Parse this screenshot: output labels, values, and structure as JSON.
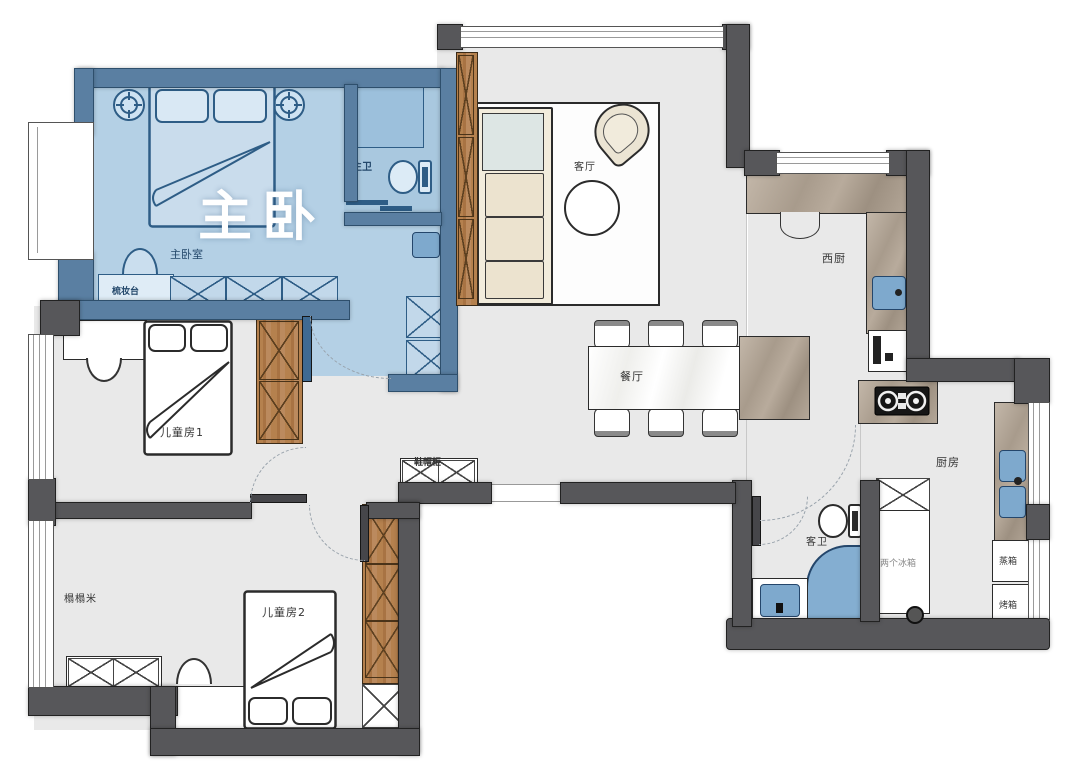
{
  "title": "户型平面图",
  "colors": {
    "wall": "#57575a",
    "floor": "#e9e9e9",
    "master_wall": "#5a7fa2",
    "master_floor": "#b4d0e5",
    "master_stroke": "#2e5d86",
    "wood": "#b5814e",
    "marble": "#b0a496",
    "sofa_cream": "#ece3cf",
    "water_blue": "#7ea9cd",
    "outline": "#2b2b2b",
    "overlay_text": "#ffffff"
  },
  "labels": {
    "master_overlay": "主卧",
    "master_bedroom": "主卧室",
    "master_bath": "主卫",
    "dresser": "梳妆台",
    "living": "客厅",
    "dining": "餐厅",
    "west_kitchen": "西厨",
    "kitchen": "厨房",
    "guest_bath": "客卫",
    "kids_room_1": "儿童房1",
    "kids_room_2": "儿童房2",
    "tatami": "榻榻米",
    "shoe_cabinet": "鞋帽柜",
    "fridges": "两个冰箱",
    "steam_oven": "蒸箱",
    "oven": "烤箱"
  }
}
